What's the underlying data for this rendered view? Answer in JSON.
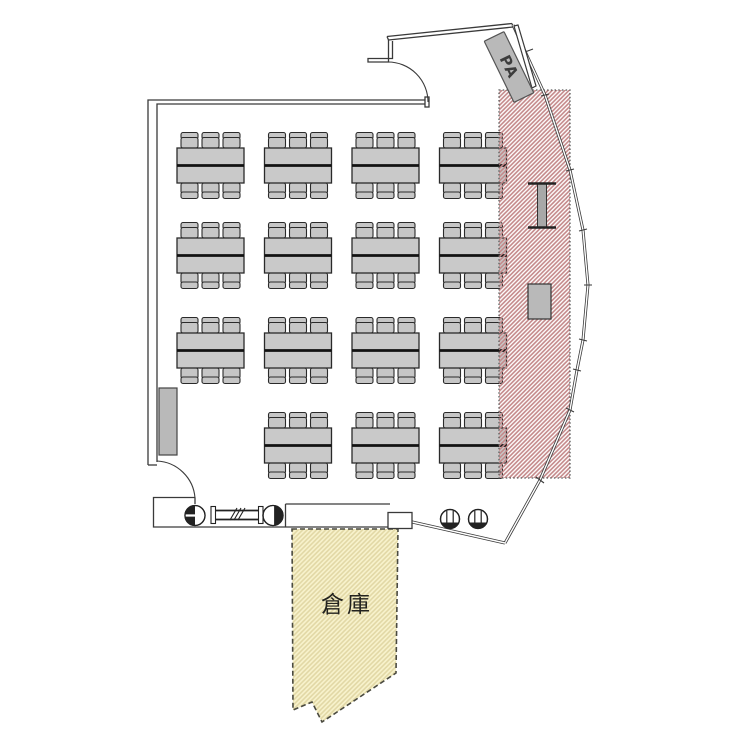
{
  "plan": {
    "pa_label": "PA",
    "storage_label": "倉庫"
  },
  "colors": {
    "wall_line": "#3a3a3a",
    "table_fill": "#c9c9c9",
    "chair_fill": "#c6c6c6",
    "equipment_gray": "#b9b9b9",
    "stage_area_hatch": "#c4898a",
    "storage_area_fill": "#f8f3cd",
    "storage_area_hatch": "#e2d8a6"
  },
  "furniture": {
    "table_groups": 15,
    "chairs_per_table": 6,
    "grid": {
      "col_x": [
        177,
        264.5,
        352,
        439.5
      ],
      "row_y": [
        148,
        238,
        333,
        428
      ],
      "skip_cells": [
        [
          3,
          0
        ]
      ],
      "table_w": 67,
      "table_h": 35
    }
  }
}
